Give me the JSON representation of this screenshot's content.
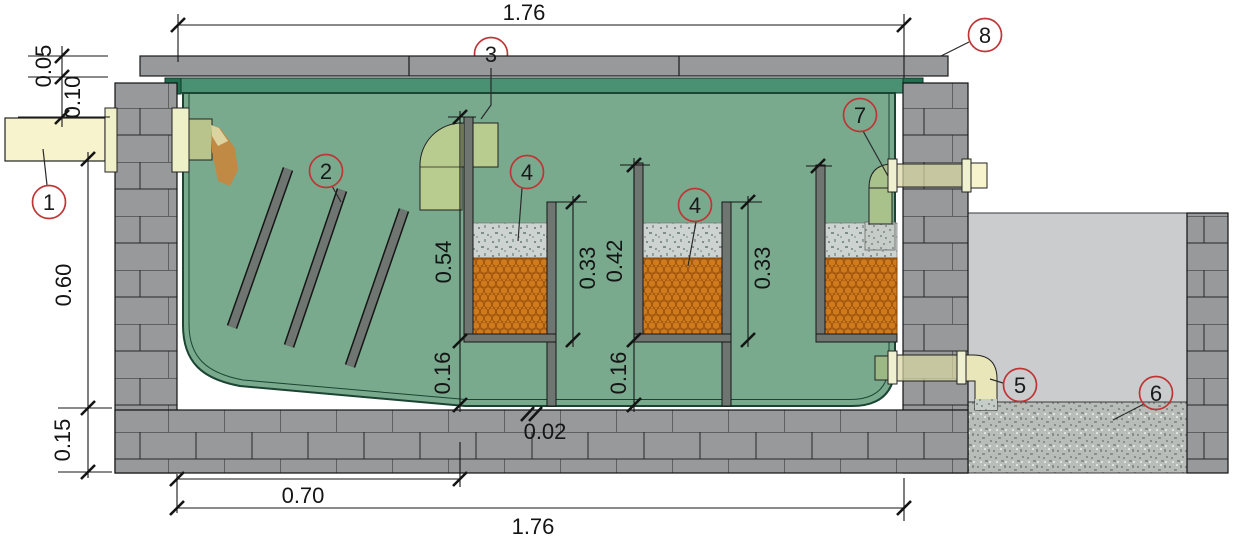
{
  "dimensions": {
    "overall_width_top": "1.76",
    "cover_thickness": "0.05",
    "inlet_offset": "0.10",
    "tank_depth": "0.60",
    "base_thickness": "0.15",
    "floor_run": "0.70",
    "overall_width_bottom": "1.76",
    "floor_slope": "0.02",
    "baffle1_height": "0.54",
    "under_tray_gap_1": "0.16",
    "tray1_wall_height": "0.33",
    "baffle2_height": "0.42",
    "under_tray_gap_2": "0.16",
    "tray2_wall_height": "0.33"
  },
  "callouts": {
    "item1": "1",
    "item2": "2",
    "item3": "3",
    "item4a": "4",
    "item4b": "4",
    "item5": "5",
    "item6": "6",
    "item7": "7",
    "item8": "8"
  },
  "colors": {
    "masonry": "#97999b",
    "cover": "#97999b",
    "tank_green": "#79aa8e",
    "rim_green": "#4a9173",
    "rim_dark": "#20704f",
    "baffle_gray": "#6f7672",
    "media_orange": "#d6832b",
    "gravel_gray": "#cdd3d0",
    "pipe_yellow": "#f6f3cd",
    "pipe_olive": "#b9c48c",
    "elbow_green": "#b9cc90",
    "pit_gray": "#cbccce",
    "pit_gravel": "#b9bdba",
    "flow_brown": "#c08a44",
    "callout_red": "#bf3434"
  }
}
